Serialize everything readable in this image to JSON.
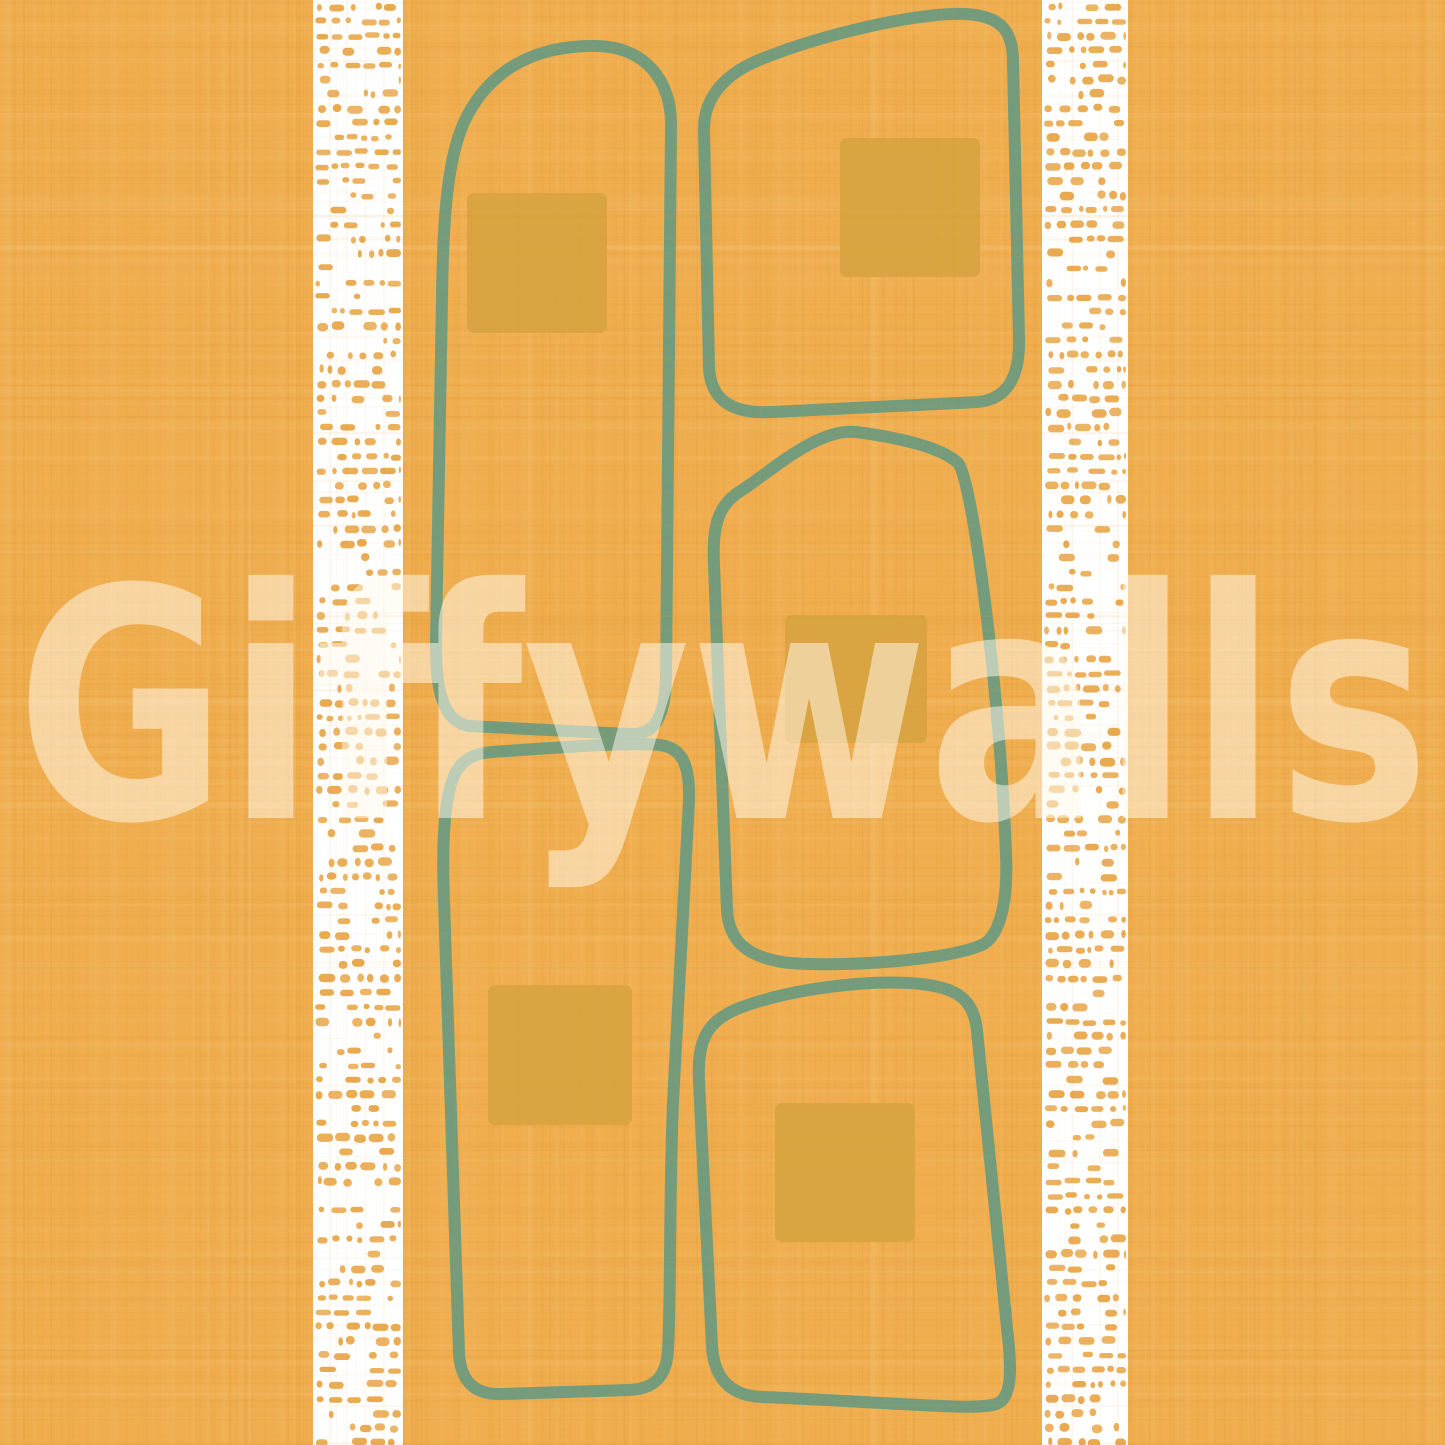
{
  "artwork": {
    "watermark": {
      "text": "Giffywalls",
      "x": 16,
      "baseline_y": 818,
      "font_size": 320,
      "text_length": 1414,
      "color": "rgba(255,250,236,0.52)"
    },
    "palette": {
      "background": "#F0AE50",
      "weave_dark": "#DC9832",
      "weave_light": "#F8C87A",
      "square_fill": "#D9A342",
      "outline_stroke": "#699A80",
      "stripe_background": "#FFFFFF",
      "stripe_dash": "#E9A94E"
    },
    "stripes": [
      {
        "name": "left-stripe",
        "x": 313,
        "width": 90
      },
      {
        "name": "right-stripe",
        "x": 1042,
        "width": 86
      }
    ],
    "stripe_style": {
      "row_spacing": 14.5,
      "dash_height": 7,
      "first_row_y": 7
    },
    "outline_style": {
      "stroke_width": 12,
      "opacity": 0.92
    },
    "shapes": [
      {
        "name": "stone-outline-1",
        "path": "M 592 46 C 540 46 492 66 466 118 C 448 154 443 214 442 298 L 436 640 C 435 692 444 722 469 726 L 628 734 C 655 736 665 717 666 678 L 671 126 C 672 82 646 45 592 46 Z"
      },
      {
        "name": "stone-outline-2",
        "path": "M 764 58 C 830 32 922 12 966 14 C 1002 16 1013 32 1013 62 L 1019 338 C 1020 374 1009 399 978 402 L 772 412 C 736 414 711 403 709 368 L 704 132 C 703 100 722 74 764 58 Z"
      },
      {
        "name": "stone-outline-3",
        "path": "M 856 432 C 902 438 942 448 958 463 C 972 477 1000 690 1006 855 C 1008 898 1001 933 984 944 C 942 964 806 968 777 961 C 748 955 729 942 727 910 L 714 565 C 712 523 719 504 742 490 C 774 469 818 428 856 432 Z"
      },
      {
        "name": "stone-outline-4",
        "path": "M 506 751 C 566 747 632 742 660 745 C 683 748 690 766 689 801 L 673 1102 C 669 1200 671 1300 668 1349 C 667 1377 654 1389 629 1390 L 502 1394 C 476 1395 461 1383 459 1354 L 444 902 C 441 822 447 781 460 766 C 471 753 486 752 506 751 Z"
      },
      {
        "name": "stone-outline-5",
        "path": "M 742 1007 C 794 988 872 979 921 984 C 958 988 974 1000 977 1031 L 1007 1328 C 1011 1363 1014 1398 996 1404 C 975 1411 906 1403 762 1397 C 731 1396 714 1379 712 1346 L 699 1082 C 697 1041 706 1020 742 1007 Z"
      }
    ],
    "squares": [
      {
        "name": "accent-square-1",
        "x": 467,
        "y": 193,
        "w": 140,
        "h": 140
      },
      {
        "name": "accent-square-2",
        "x": 840,
        "y": 138,
        "w": 140,
        "h": 139
      },
      {
        "name": "accent-square-3",
        "x": 785,
        "y": 615,
        "w": 142,
        "h": 128
      },
      {
        "name": "accent-square-4",
        "x": 488,
        "y": 985,
        "w": 144,
        "h": 140
      },
      {
        "name": "accent-square-5",
        "x": 775,
        "y": 1103,
        "w": 140,
        "h": 139
      }
    ]
  }
}
